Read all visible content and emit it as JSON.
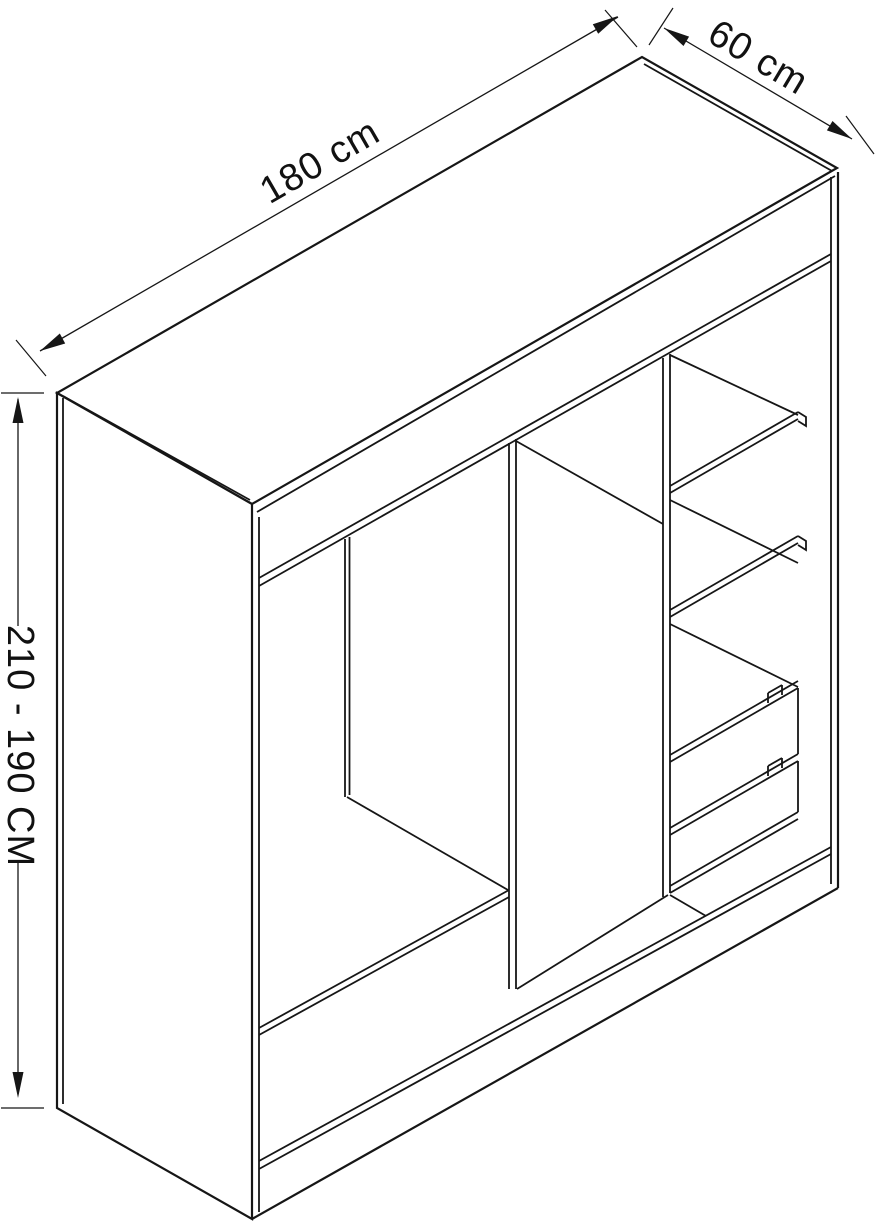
{
  "diagram": {
    "subject": "wardrobe interior isometric line drawing",
    "colors": {
      "line": "#161616",
      "background": "#ffffff",
      "text": "#111111"
    },
    "dimensions": {
      "width_label": "180 cm",
      "depth_label": "60 cm",
      "height_label": "210 - 190 CM"
    }
  }
}
